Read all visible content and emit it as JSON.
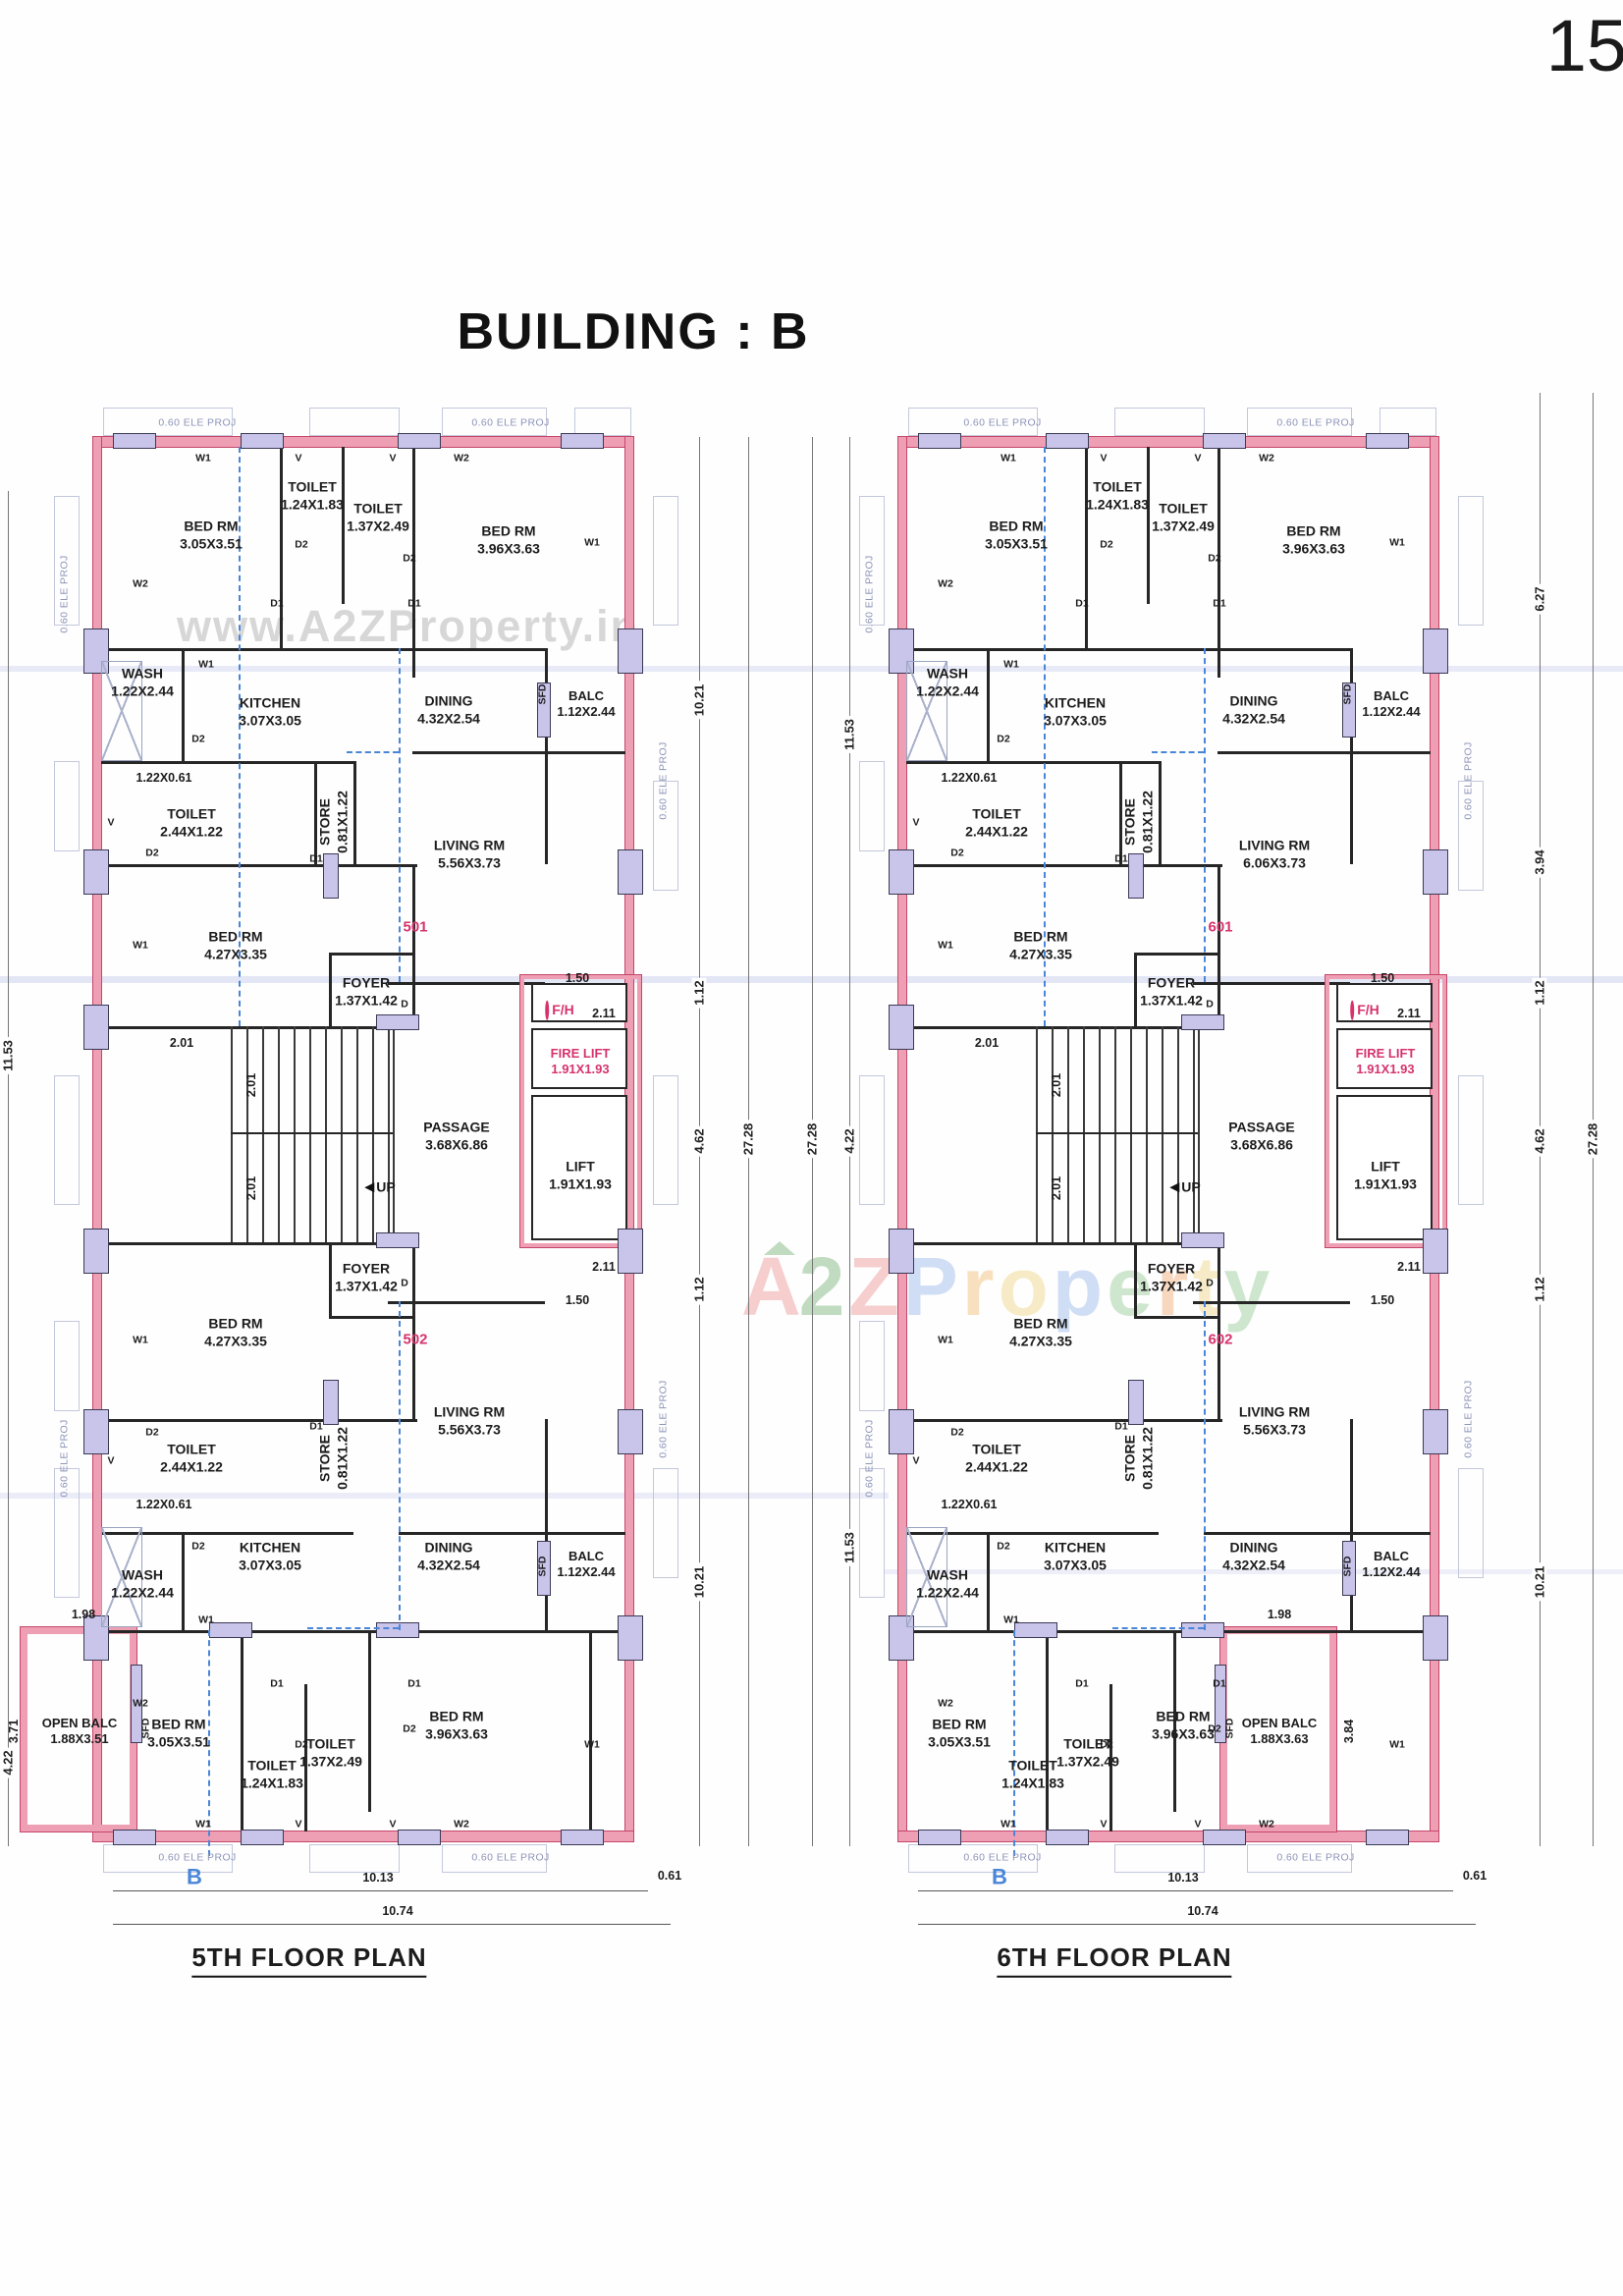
{
  "page": {
    "number": "15",
    "title": "BUILDING : B"
  },
  "watermark": {
    "top": "www.A2ZProperty.in",
    "center_letters": [
      {
        "ch": "A",
        "color": "#f2a7a7"
      },
      {
        "ch": "2",
        "color": "#8fbf8f"
      },
      {
        "ch": "Z",
        "color": "#f2a7a7"
      },
      {
        "ch": "P",
        "color": "#a9c3ee"
      },
      {
        "ch": "r",
        "color": "#f4c98c"
      },
      {
        "ch": "o",
        "color": "#f2dc9b"
      },
      {
        "ch": "p",
        "color": "#a9c3ee"
      },
      {
        "ch": "e",
        "color": "#a8d3a8"
      },
      {
        "ch": "r",
        "color": "#f4b98c"
      },
      {
        "ch": "t",
        "color": "#f2dc9b"
      },
      {
        "ch": "y",
        "color": "#a8d3a8"
      }
    ]
  },
  "colors": {
    "wall_pink": "#ef9fb3",
    "wall_edge": "#c4466a",
    "column_lavender": "#c9c4ea",
    "section_blue": "#4a86d8",
    "accent_pink": "#d6336c",
    "proj_text": "#8d94b8"
  },
  "tags": {
    "w1": "W1",
    "w2": "W2",
    "v": "V",
    "d1": "D1",
    "d2": "D2",
    "d": "D",
    "sfd": "SFD",
    "up": "UP",
    "b": "B",
    "fh": "F/H",
    "ele_proj": "0.60 ELE PROJ"
  },
  "shared_dims": {
    "s201": "2.01",
    "s150": "1.50",
    "s211": "2.11",
    "s1013": "10.13",
    "s061": "0.61",
    "s1074": "10.74",
    "s1021": "10.21",
    "s112": "1.12",
    "s462": "4.62",
    "s2728": "27.28",
    "s1153": "11.53",
    "s422": "4.22"
  },
  "plans": [
    {
      "caption": "5TH FLOOR PLAN",
      "apt_upper": "501",
      "apt_lower": "502",
      "side": {
        "w": "1.98",
        "h": "3.71"
      },
      "rooms": {
        "bed_tl": {
          "n": "BED RM",
          "d": "3.05X3.51"
        },
        "toilet_a": {
          "n": "TOILET",
          "d": "1.24X1.83"
        },
        "toilet_b": {
          "n": "TOILET",
          "d": "1.37X2.49"
        },
        "bed_tr": {
          "n": "BED RM",
          "d": "3.96X3.63"
        },
        "wash_u": {
          "n": "WASH",
          "d": "1.22X2.44"
        },
        "kitchen_u": {
          "n": "KITCHEN",
          "d": "3.07X3.05"
        },
        "dining_u": {
          "n": "DINING",
          "d": "4.32X2.54"
        },
        "balc_u": {
          "n": "BALC",
          "d": "1.12X2.44"
        },
        "toilet_c": {
          "n": "TOILET",
          "d": "2.44X1.22"
        },
        "toilet_c_niche": "1.22X0.61",
        "store_u": {
          "n": "STORE",
          "d": "0.81X1.22"
        },
        "living_u": {
          "n": "LIVING RM",
          "d": "5.56X3.73"
        },
        "bed_ml": {
          "n": "BED RM",
          "d": "4.27X3.35"
        },
        "foyer_u": {
          "n": "FOYER",
          "d": "1.37X1.42"
        },
        "passage": {
          "n": "PASSAGE",
          "d": "3.68X6.86"
        },
        "fire_lift": {
          "n": "FIRE LIFT",
          "d": "1.91X1.93"
        },
        "lift": {
          "n": "LIFT",
          "d": "1.91X1.93"
        },
        "foyer_l": {
          "n": "FOYER",
          "d": "1.37X1.42"
        },
        "bed_ml2": {
          "n": "BED RM",
          "d": "4.27X3.35"
        },
        "living_l": {
          "n": "LIVING RM",
          "d": "5.56X3.73"
        },
        "toilet_d": {
          "n": "TOILET",
          "d": "2.44X1.22"
        },
        "toilet_d_niche": "1.22X0.61",
        "store_l": {
          "n": "STORE",
          "d": "0.81X1.22"
        },
        "wash_l": {
          "n": "WASH",
          "d": "1.22X2.44"
        },
        "kitchen_l": {
          "n": "KITCHEN",
          "d": "3.07X3.05"
        },
        "dining_l": {
          "n": "DINING",
          "d": "4.32X2.54"
        },
        "balc_l": {
          "n": "BALC",
          "d": "1.12X2.44"
        },
        "bed_bl": {
          "n": "BED RM",
          "d": "3.05X3.51"
        },
        "toilet_e": {
          "n": "TOILET",
          "d": "1.24X1.83"
        },
        "toilet_f": {
          "n": "TOILET",
          "d": "1.37X2.49"
        },
        "bed_br": {
          "n": "BED RM",
          "d": "3.96X3.63"
        },
        "open_balc": {
          "n": "OPEN BALC",
          "d": "1.88X3.51"
        }
      }
    },
    {
      "caption": "6TH FLOOR PLAN",
      "apt_upper": "601",
      "apt_lower": "602",
      "side": {
        "w": "1.98",
        "h": "3.84"
      },
      "dim_627": "6.27",
      "dim_394": "3.94",
      "rooms": {
        "bed_tl": {
          "n": "BED RM",
          "d": "3.05X3.51"
        },
        "toilet_a": {
          "n": "TOILET",
          "d": "1.24X1.83"
        },
        "toilet_b": {
          "n": "TOILET",
          "d": "1.37X2.49"
        },
        "bed_tr": {
          "n": "BED RM",
          "d": "3.96X3.63"
        },
        "wash_u": {
          "n": "WASH",
          "d": "1.22X2.44"
        },
        "kitchen_u": {
          "n": "KITCHEN",
          "d": "3.07X3.05"
        },
        "dining_u": {
          "n": "DINING",
          "d": "4.32X2.54"
        },
        "balc_u": {
          "n": "BALC",
          "d": "1.12X2.44"
        },
        "toilet_c": {
          "n": "TOILET",
          "d": "2.44X1.22"
        },
        "toilet_c_niche": "1.22X0.61",
        "store_u": {
          "n": "STORE",
          "d": "0.81X1.22"
        },
        "living_u": {
          "n": "LIVING RM",
          "d": "6.06X3.73"
        },
        "bed_ml": {
          "n": "BED RM",
          "d": "4.27X3.35"
        },
        "foyer_u": {
          "n": "FOYER",
          "d": "1.37X1.42"
        },
        "passage": {
          "n": "PASSAGE",
          "d": "3.68X6.86"
        },
        "fire_lift": {
          "n": "FIRE LIFT",
          "d": "1.91X1.93"
        },
        "lift": {
          "n": "LIFT",
          "d": "1.91X1.93"
        },
        "foyer_l": {
          "n": "FOYER",
          "d": "1.37X1.42"
        },
        "bed_ml2": {
          "n": "BED RM",
          "d": "4.27X3.35"
        },
        "living_l": {
          "n": "LIVING RM",
          "d": "5.56X3.73"
        },
        "toilet_d": {
          "n": "TOILET",
          "d": "2.44X1.22"
        },
        "toilet_d_niche": "1.22X0.61",
        "store_l": {
          "n": "STORE",
          "d": "0.81X1.22"
        },
        "wash_l": {
          "n": "WASH",
          "d": "1.22X2.44"
        },
        "kitchen_l": {
          "n": "KITCHEN",
          "d": "3.07X3.05"
        },
        "dining_l": {
          "n": "DINING",
          "d": "4.32X2.54"
        },
        "balc_l": {
          "n": "BALC",
          "d": "1.12X2.44"
        },
        "bed_bl": {
          "n": "BED RM",
          "d": "3.05X3.51"
        },
        "toilet_e": {
          "n": "TOILET",
          "d": "1.24X1.83"
        },
        "toilet_f": {
          "n": "TOILET",
          "d": "1.37X2.49"
        },
        "bed_br": {
          "n": "BED RM",
          "d": "3.96X3.63"
        },
        "open_balc": {
          "n": "OPEN BALC",
          "d": "1.88X3.63"
        }
      }
    }
  ]
}
